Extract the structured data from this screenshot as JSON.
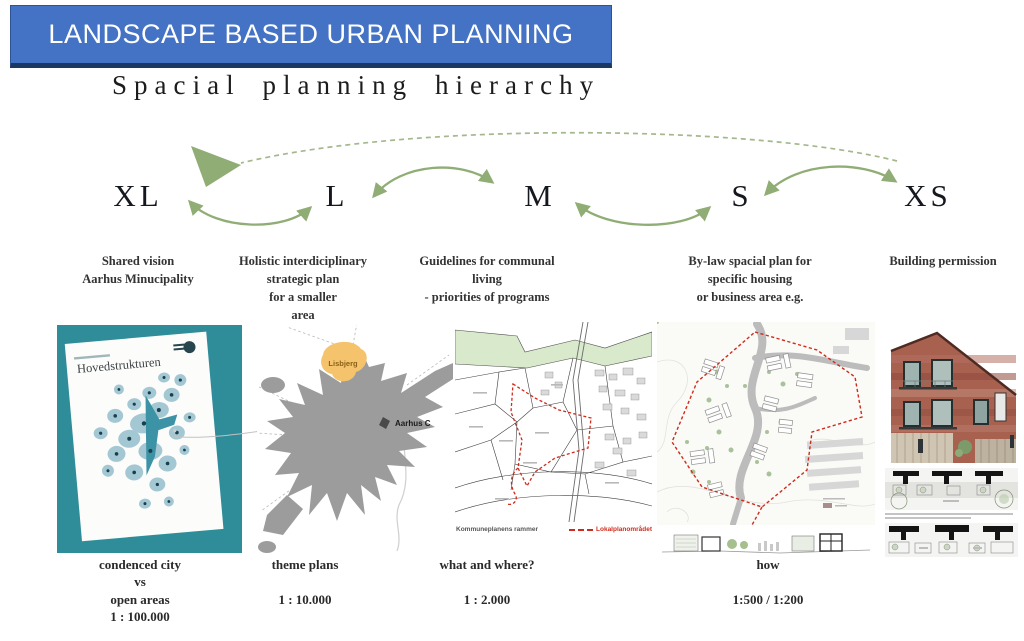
{
  "banner": {
    "title": "LANDSCAPE BASED URBAN PLANNING"
  },
  "heading": "Spacial planning hierarchy",
  "columns": [
    {
      "scale": "XL",
      "description": "Shared vision\nAarhus Minucipality",
      "caption": "condenced city\nvs\nopen areas\n1 : 100.000"
    },
    {
      "scale": "L",
      "description": "Holistic interdiciplinary\nstrategic plan\nfor a smaller\narea",
      "caption": "theme plans\n\n1 : 10.000"
    },
    {
      "scale": "M",
      "description": "Guidelines for communal\nliving\n- priorities of programs",
      "caption": "what and where?\n\n1 : 2.000"
    },
    {
      "scale": "S",
      "description": "By-law spacial plan for\nspecific housing\nor business area e.g.",
      "caption": "how\n\n1:500 / 1:200"
    },
    {
      "scale": "XS",
      "description": "Building permission",
      "caption": ""
    }
  ],
  "graphics": {
    "xl_poster_title": "Hovedstrukturen",
    "l_map": {
      "area_label": "Lisbjerg",
      "city_label": "Aarhus C"
    },
    "m_map": {
      "caption": "Kommuneplanens rammer",
      "legend_label": "Lokalplanområdet"
    }
  },
  "colors": {
    "banner_blue": "#4472c4",
    "banner_border": "#1b3764",
    "arrow_green": "#8fad74",
    "poster_teal": "#2e8d99",
    "map_gray": "#9c9c9c",
    "highlight_orange": "#f4c36c",
    "plan_red": "#cf2b1c",
    "band_green": "#d8e9cc"
  }
}
